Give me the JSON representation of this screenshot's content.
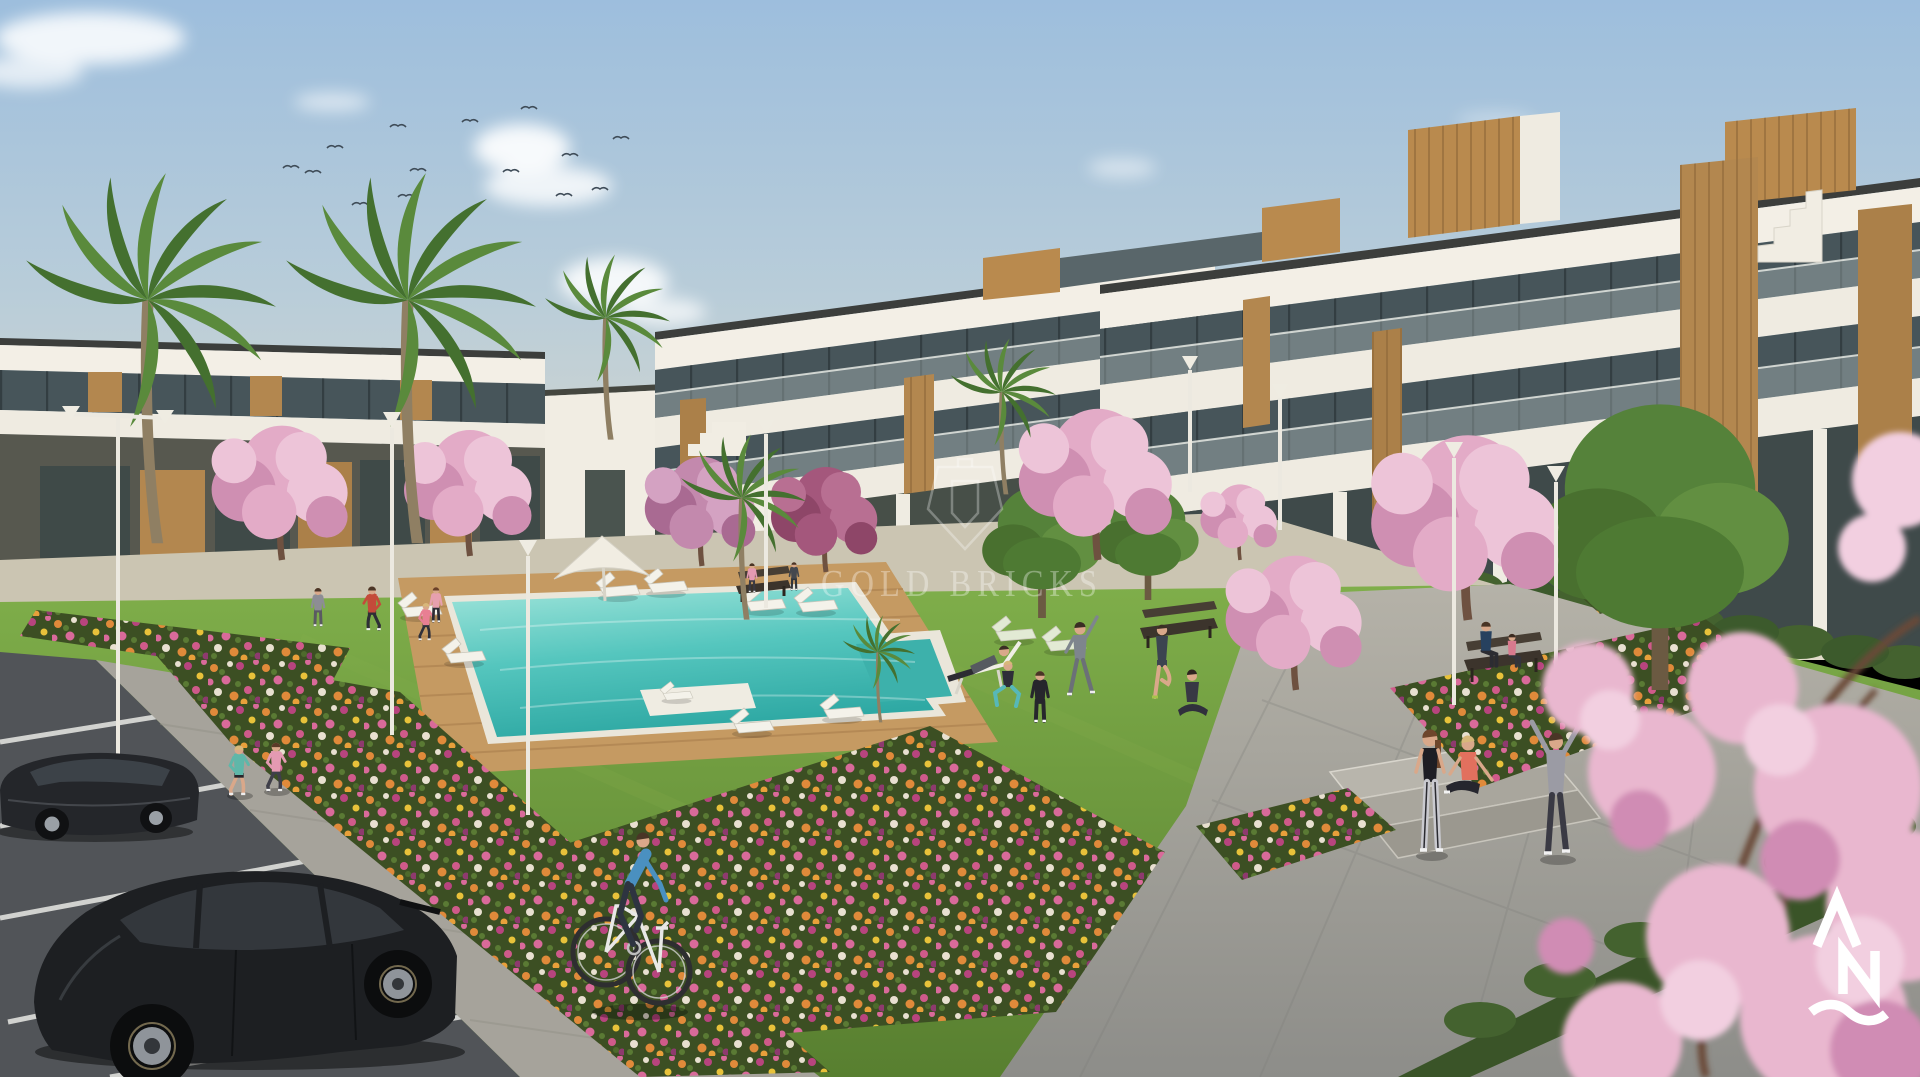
{
  "image": {
    "kind": "3d-architectural-render",
    "subject": "Modern white residential apartment complex with communal lawn, swimming pool, gardens, parking and people exercising",
    "time_of_day": "daytime, clear sky"
  },
  "watermark": {
    "text": "GOLD BRICKS",
    "icon": "lantern-outline-icon",
    "color": "#ffffff",
    "opacity": 0.32
  },
  "logo_bottom_right": {
    "letters": "AN",
    "elements": [
      "caret-A-glyph",
      "letter-N-glyph",
      "wave-underline"
    ],
    "color": "#ffffff"
  },
  "palette": {
    "sky_top": "#9dbedd",
    "sky_horizon": "#e2dccb",
    "building_white": "#f3efe6",
    "wood_accent": "#b3874f",
    "glass_dark": "#47555a",
    "lawn_green": "#6f9a3d",
    "pool_water": "#52c4bd",
    "deck_wood": "#c59a62",
    "path_grey": "#a6a39b",
    "asphalt_grey": "#515458",
    "blossom_pink": "#e3abc7",
    "hedge_green": "#3c5a2c",
    "car_black": "#1f2124"
  },
  "scene": {
    "buildings": [
      "left two-storey block",
      "center back wing (3 floors)",
      "right front wing (3 floors) with wooden roof boxes and stair tower"
    ],
    "vegetation": [
      "palm trees",
      "pink blossom trees",
      "flower beds",
      "hedges",
      "large lawn"
    ],
    "pool": {
      "loungers": 11,
      "parasols": 1,
      "shape": "L-shaped with deck peninsula"
    },
    "people": [
      "two joggers",
      "runner by pool",
      "group exercising on lawn",
      "seated yoga woman",
      "three people by plaza steps",
      "couple on bench",
      "cyclist"
    ],
    "vehicles": [
      "black sedan",
      "black hatchback"
    ],
    "birds": 14,
    "street_lamps": 8
  }
}
